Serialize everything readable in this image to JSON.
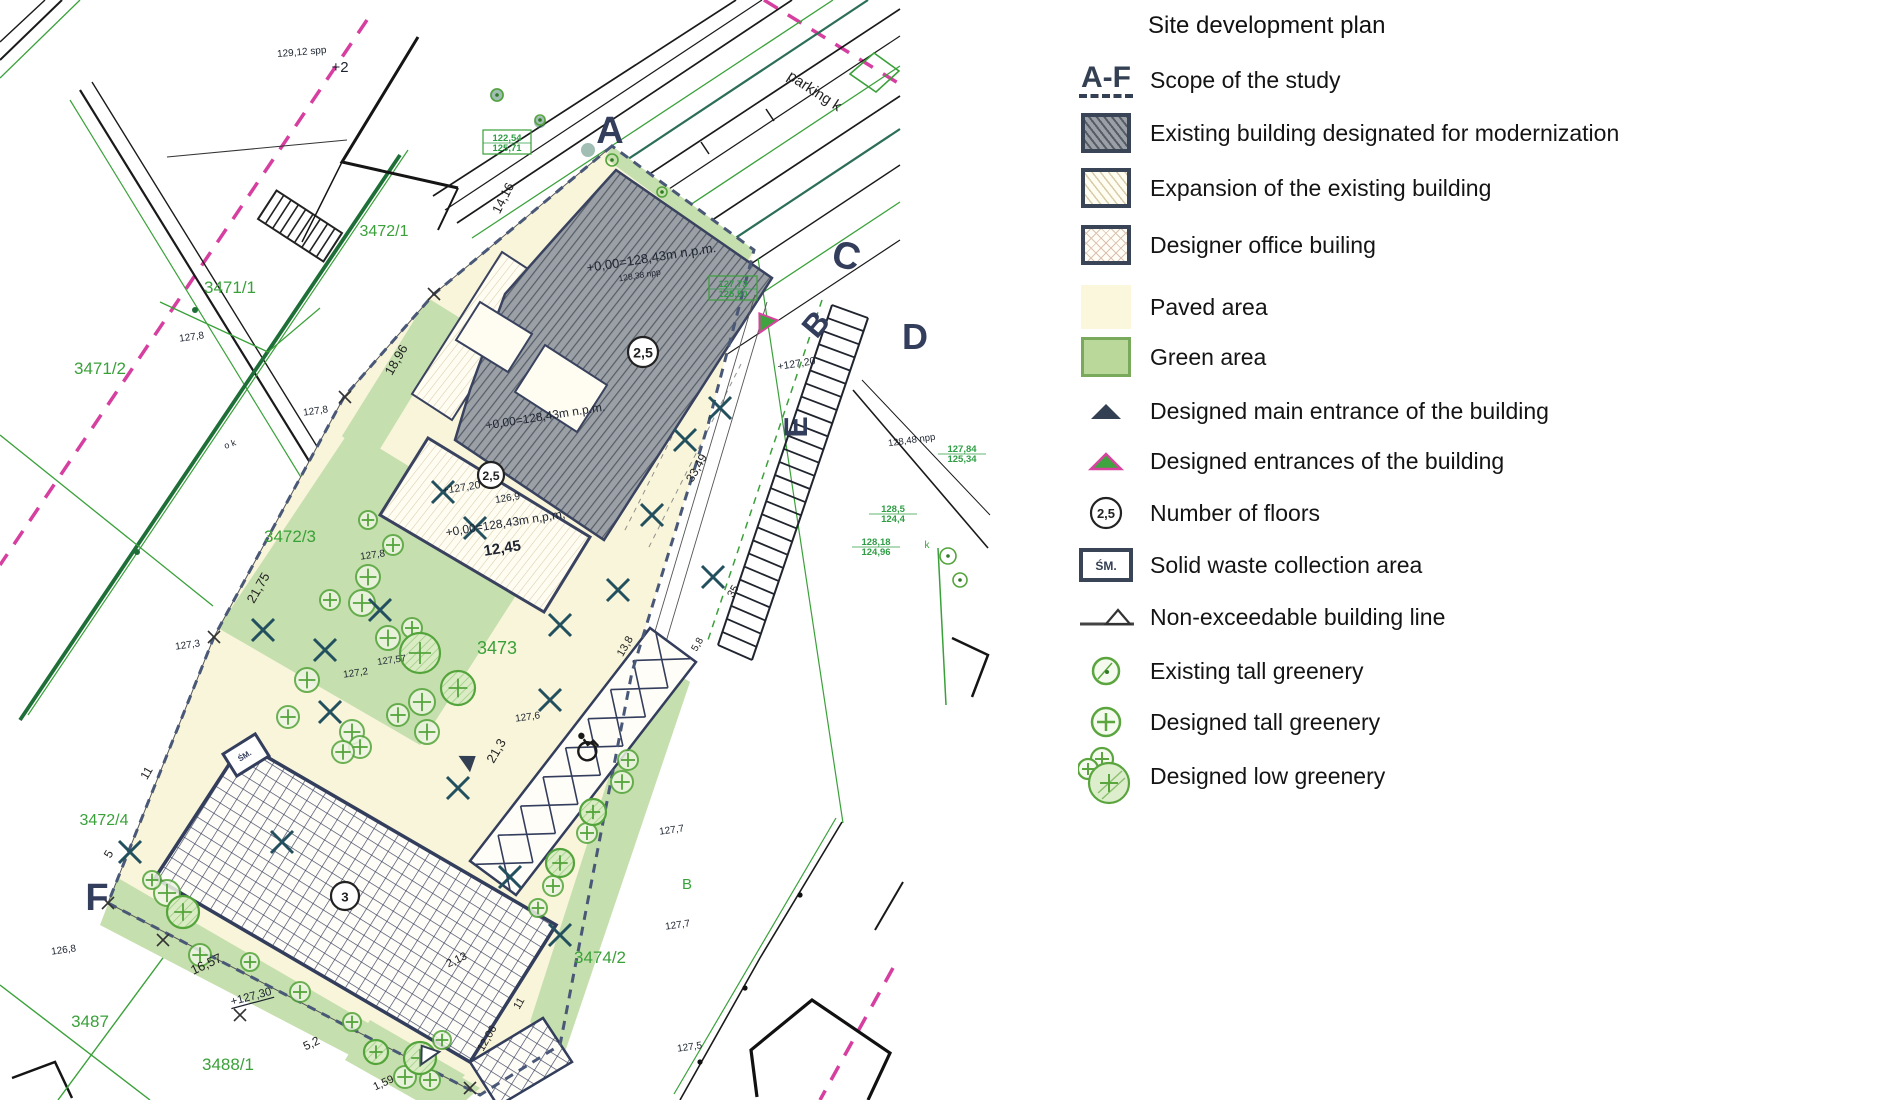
{
  "title": "Site development plan",
  "colors": {
    "paved": "#f8f5da",
    "green": "#c6dfae",
    "greenLine": "#3aa13a",
    "darkGreen": "#1e6e38",
    "teal": "#2c6e57",
    "navy": "#333d5c",
    "gray": "#9ba0a6",
    "grayHatch": "#565c66",
    "magenta": "#d63fa0",
    "ink": "#1d2430",
    "dim": "#222222",
    "tree": "#54a43c"
  },
  "legend": {
    "scope_symbol": "A-F",
    "floors_symbol": "2,5",
    "waste_symbol": "ŚM.",
    "items": [
      {
        "id": "scope",
        "label": "Scope of the study"
      },
      {
        "id": "modernization",
        "label": "Existing building designated for modernization"
      },
      {
        "id": "expansion",
        "label": " Expansion of the existing building"
      },
      {
        "id": "designer-office",
        "label": "Designer office builing"
      },
      {
        "id": "paved",
        "label": "Paved area"
      },
      {
        "id": "green",
        "label": "Green area"
      },
      {
        "id": "main-entrance",
        "label": "Designed main entrance of the building"
      },
      {
        "id": "entrances",
        "label": "Designed entrances of the building"
      },
      {
        "id": "floors",
        "label": "Number of floors"
      },
      {
        "id": "waste",
        "label": "Solid waste collection area"
      },
      {
        "id": "building-line",
        "label": "Non-exceedable building line"
      },
      {
        "id": "existing-tall",
        "label": "Existing tall greenery"
      },
      {
        "id": "designed-tall",
        "label": "Designed tall greenery"
      },
      {
        "id": "designed-low",
        "label": "Designed low greenery"
      }
    ]
  },
  "map": {
    "floor_markers": [
      {
        "value": "2,5",
        "x": 643,
        "y": 352,
        "r": 15
      },
      {
        "value": "2,5",
        "x": 491,
        "y": 475,
        "r": 13
      },
      {
        "value": "3",
        "x": 345,
        "y": 896,
        "r": 14
      }
    ],
    "utility_labels": [
      {
        "lines": [
          "122,54",
          "125,71"
        ],
        "x": 507,
        "y": 141,
        "boxed": true
      },
      {
        "lines": [
          "127,73",
          "125,50"
        ],
        "x": 733,
        "y": 287,
        "boxed": true
      },
      {
        "lines": [
          "128,18",
          "124,96"
        ],
        "x": 876,
        "y": 545,
        "boxed": false
      },
      {
        "lines": [
          "127,84",
          "125,34"
        ],
        "x": 962,
        "y": 452,
        "boxed": false
      },
      {
        "lines": [
          "128,5",
          "124,4"
        ],
        "x": 893,
        "y": 512,
        "boxed": false
      }
    ],
    "labels": [
      {
        "t": "3471/1",
        "x": 230,
        "y": 293,
        "s": 17,
        "r": 0,
        "c": "greenLine",
        "n": "parcel-label"
      },
      {
        "t": "3471/2",
        "x": 100,
        "y": 374,
        "s": 17,
        "r": 0,
        "c": "greenLine",
        "n": "parcel-label"
      },
      {
        "t": "3472/1",
        "x": 384,
        "y": 236,
        "s": 16,
        "r": 0,
        "c": "greenLine",
        "n": "parcel-label"
      },
      {
        "t": "3472/3",
        "x": 290,
        "y": 542,
        "s": 17,
        "r": 0,
        "c": "greenLine",
        "n": "parcel-label"
      },
      {
        "t": "3472/4",
        "x": 104,
        "y": 825,
        "s": 16,
        "r": 0,
        "c": "greenLine",
        "n": "parcel-label"
      },
      {
        "t": "3473",
        "x": 497,
        "y": 654,
        "s": 18,
        "r": 0,
        "c": "greenLine",
        "n": "parcel-label"
      },
      {
        "t": "3474/2",
        "x": 600,
        "y": 963,
        "s": 17,
        "r": 0,
        "c": "greenLine",
        "n": "parcel-label"
      },
      {
        "t": "3487",
        "x": 90,
        "y": 1027,
        "s": 17,
        "r": 0,
        "c": "greenLine",
        "n": "parcel-label"
      },
      {
        "t": "3488/1",
        "x": 228,
        "y": 1070,
        "s": 17,
        "r": 0,
        "c": "greenLine",
        "n": "parcel-label"
      },
      {
        "t": "B",
        "x": 687,
        "y": 889,
        "s": 15,
        "r": 0,
        "c": "greenLine",
        "n": "parcel-label"
      },
      {
        "t": "A",
        "x": 610,
        "y": 143,
        "s": 38,
        "r": 0,
        "c": "navy",
        "b": 1,
        "n": "section-letter"
      },
      {
        "t": "C",
        "x": 843,
        "y": 268,
        "s": 38,
        "r": 15,
        "c": "navy",
        "b": 1,
        "n": "section-letter"
      },
      {
        "t": "D",
        "x": 915,
        "y": 349,
        "s": 36,
        "r": 0,
        "c": "navy",
        "b": 1,
        "n": "section-letter"
      },
      {
        "t": "B",
        "x": 824,
        "y": 331,
        "s": 32,
        "r": -50,
        "c": "navy",
        "b": 1,
        "n": "section-letter"
      },
      {
        "t": "E",
        "x": 807,
        "y": 427,
        "s": 32,
        "r": -90,
        "c": "navy",
        "b": 1,
        "n": "section-letter"
      },
      {
        "t": "F",
        "x": 97,
        "y": 910,
        "s": 38,
        "r": 0,
        "c": "navy",
        "b": 1,
        "n": "section-letter"
      },
      {
        "t": "+0,00=128,43m n.p.m.",
        "x": 652,
        "y": 262,
        "s": 13,
        "r": -9,
        "c": "ink",
        "n": "elevation-label"
      },
      {
        "t": "128,38 npp",
        "x": 640,
        "y": 278,
        "s": 8.5,
        "r": -9,
        "c": "ink",
        "n": "elevation-label"
      },
      {
        "t": "+0,00=128,43m n.p.m.",
        "x": 546,
        "y": 420,
        "s": 12,
        "r": -9,
        "c": "ink",
        "n": "elevation-label"
      },
      {
        "t": "126,9",
        "x": 508,
        "y": 501,
        "s": 10,
        "r": -9,
        "c": "ink",
        "n": "elevation-label"
      },
      {
        "t": "+0,00=128,43m n,p,m,",
        "x": 506,
        "y": 527,
        "s": 12,
        "r": -9,
        "c": "ink",
        "n": "elevation-label"
      },
      {
        "t": "12,45",
        "x": 503,
        "y": 553,
        "s": 15,
        "r": -9,
        "c": "ink",
        "b": 1,
        "n": "dimension-label"
      },
      {
        "t": "+127,20",
        "x": 462,
        "y": 491,
        "s": 10.5,
        "r": -9,
        "c": "ink",
        "n": "elevation-label"
      },
      {
        "t": "+127,20",
        "x": 797,
        "y": 367,
        "s": 10.5,
        "r": -9,
        "c": "ink",
        "n": "elevation-label"
      },
      {
        "t": "+127,30",
        "x": 252,
        "y": 1000,
        "s": 11.5,
        "r": -15,
        "c": "ink",
        "u": 1,
        "n": "elevation-label"
      },
      {
        "t": "127,8",
        "x": 192,
        "y": 340,
        "s": 10,
        "r": -8,
        "c": "ink",
        "n": "spot-height"
      },
      {
        "t": "127,8",
        "x": 316,
        "y": 414,
        "s": 10,
        "r": -8,
        "c": "ink",
        "n": "spot-height"
      },
      {
        "t": "127,8",
        "x": 373,
        "y": 558,
        "s": 10,
        "r": -8,
        "c": "ink",
        "n": "spot-height"
      },
      {
        "t": "127,3",
        "x": 188,
        "y": 648,
        "s": 10,
        "r": -8,
        "c": "ink",
        "n": "spot-height"
      },
      {
        "t": "127,2",
        "x": 356,
        "y": 676,
        "s": 10,
        "r": -8,
        "c": "ink",
        "n": "spot-height"
      },
      {
        "t": "127,57",
        "x": 392,
        "y": 663,
        "s": 9.5,
        "r": -8,
        "c": "ink",
        "n": "spot-height"
      },
      {
        "t": "127,6",
        "x": 528,
        "y": 720,
        "s": 10,
        "r": -8,
        "c": "ink",
        "n": "spot-height"
      },
      {
        "t": "127,7",
        "x": 672,
        "y": 833,
        "s": 10,
        "r": -8,
        "c": "ink",
        "n": "spot-height"
      },
      {
        "t": "127,7",
        "x": 678,
        "y": 928,
        "s": 10,
        "r": -8,
        "c": "ink",
        "n": "spot-height"
      },
      {
        "t": "127,5",
        "x": 690,
        "y": 1050,
        "s": 10,
        "r": -8,
        "c": "ink",
        "n": "spot-height"
      },
      {
        "t": "126,8",
        "x": 64,
        "y": 953,
        "s": 10,
        "r": -8,
        "c": "ink",
        "n": "spot-height"
      },
      {
        "t": "128,48 npp",
        "x": 912,
        "y": 443,
        "s": 9.5,
        "r": -8,
        "c": "ink",
        "n": "spot-height"
      },
      {
        "t": "129,12 spp",
        "x": 302,
        "y": 55,
        "s": 10,
        "r": -5,
        "c": "ink",
        "n": "spot-height"
      },
      {
        "t": "+2",
        "x": 340,
        "y": 72,
        "s": 15,
        "r": 0,
        "c": "ink",
        "n": "spot-height"
      },
      {
        "t": "o k",
        "x": 231,
        "y": 447,
        "s": 9,
        "r": -20,
        "c": "ink",
        "n": "spot-height"
      },
      {
        "t": "k",
        "x": 927,
        "y": 548,
        "s": 10,
        "r": 0,
        "c": "greenLine",
        "n": "spot-height"
      },
      {
        "t": "14,16",
        "x": 507,
        "y": 200,
        "s": 13,
        "r": -63,
        "c": "dim",
        "n": "dimension-label"
      },
      {
        "t": "18,96",
        "x": 400,
        "y": 362,
        "s": 13,
        "r": -60,
        "c": "dim",
        "n": "dimension-label"
      },
      {
        "t": "21,75",
        "x": 262,
        "y": 590,
        "s": 13,
        "r": -60,
        "c": "dim",
        "n": "dimension-label"
      },
      {
        "t": "11",
        "x": 150,
        "y": 775,
        "s": 12,
        "r": -60,
        "c": "dim",
        "n": "dimension-label"
      },
      {
        "t": "5",
        "x": 112,
        "y": 856,
        "s": 12,
        "r": -60,
        "c": "dim",
        "n": "dimension-label"
      },
      {
        "t": "16,57",
        "x": 208,
        "y": 968,
        "s": 13,
        "r": -25,
        "c": "dim",
        "n": "dimension-label"
      },
      {
        "t": "5,2",
        "x": 313,
        "y": 1047,
        "s": 12,
        "r": -25,
        "c": "dim",
        "n": "dimension-label"
      },
      {
        "t": "1,59",
        "x": 385,
        "y": 1086,
        "s": 11,
        "r": -25,
        "c": "dim",
        "n": "dimension-label"
      },
      {
        "t": "12,06",
        "x": 490,
        "y": 1040,
        "s": 11,
        "r": -60,
        "c": "dim",
        "n": "dimension-label"
      },
      {
        "t": "2,13",
        "x": 458,
        "y": 963,
        "s": 11,
        "r": -25,
        "c": "dim",
        "n": "dimension-label"
      },
      {
        "t": "11",
        "x": 522,
        "y": 1005,
        "s": 11,
        "r": -60,
        "c": "dim",
        "n": "dimension-label"
      },
      {
        "t": "21,3",
        "x": 500,
        "y": 753,
        "s": 13,
        "r": -60,
        "c": "dim",
        "n": "dimension-label"
      },
      {
        "t": "33,49",
        "x": 700,
        "y": 470,
        "s": 12,
        "r": -60,
        "c": "dim",
        "n": "dimension-label"
      },
      {
        "t": "13,8",
        "x": 628,
        "y": 648,
        "s": 11,
        "r": -60,
        "c": "dim",
        "n": "dimension-label"
      },
      {
        "t": "35",
        "x": 736,
        "y": 593,
        "s": 11,
        "r": -60,
        "c": "dim",
        "n": "dimension-label"
      },
      {
        "t": "5,8",
        "x": 700,
        "y": 646,
        "s": 10,
        "r": -60,
        "c": "dim",
        "n": "dimension-label"
      },
      {
        "t": "parking k",
        "x": 812,
        "y": 95,
        "s": 15,
        "r": 33,
        "c": "dim",
        "n": "road-label"
      },
      {
        "t": "ŚM.",
        "x": 246,
        "y": 758,
        "s": 8,
        "r": -32,
        "c": "navy",
        "b": 1,
        "n": "waste-area-label"
      }
    ]
  }
}
